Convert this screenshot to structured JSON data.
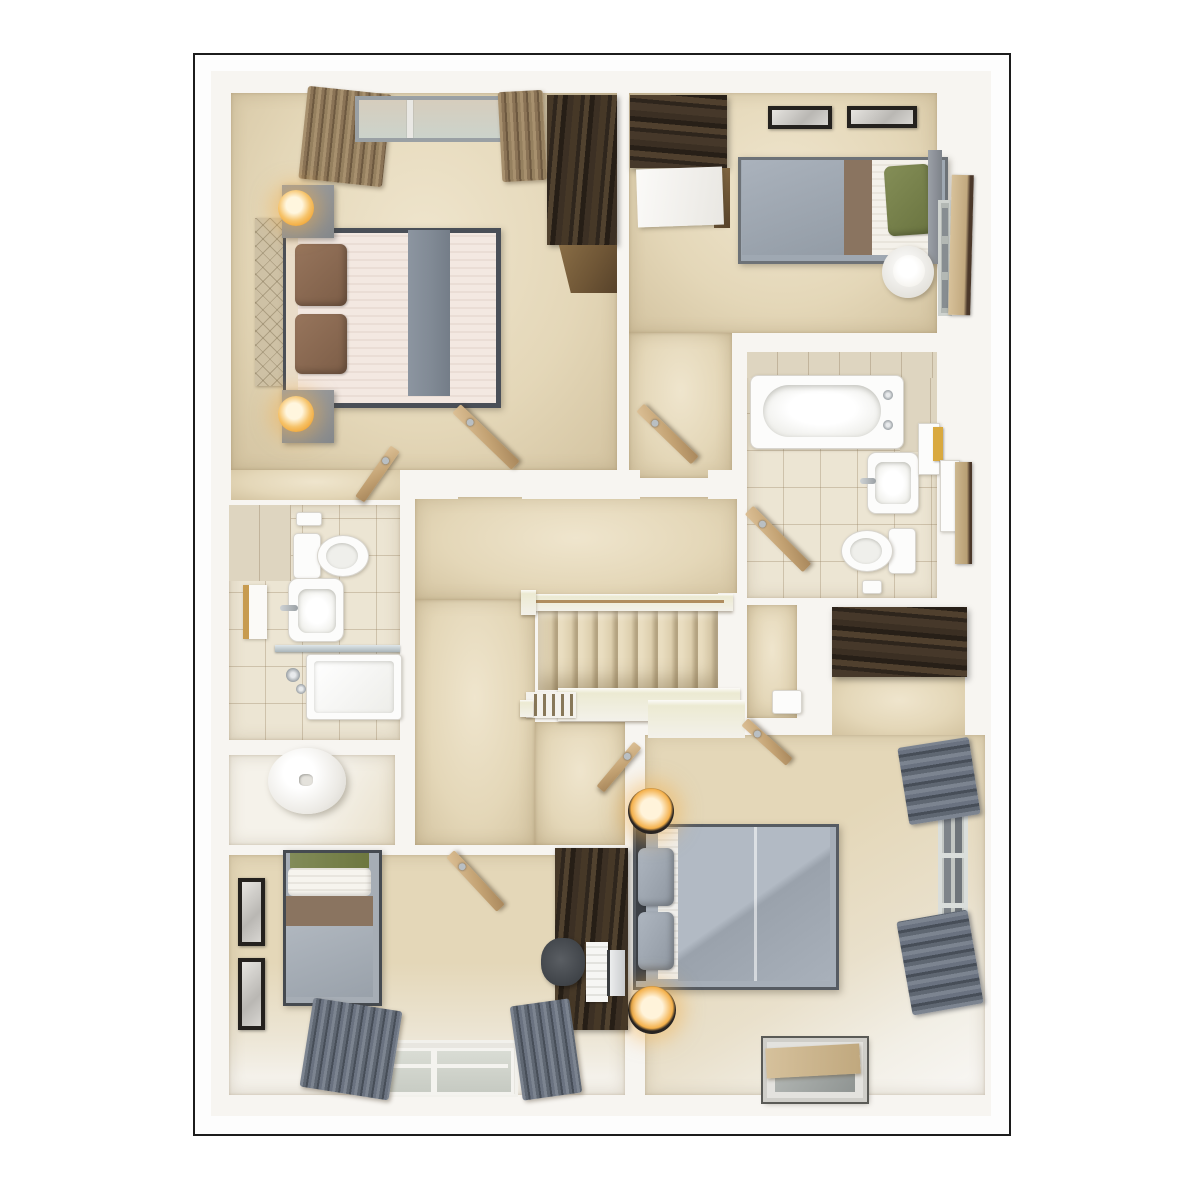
{
  "scene": {
    "description": "Top-down 3D architectural render of an upper-storey house floor plan with four bedrooms, family bathroom, en-suite shower room, airing cupboard and central landing with staircase",
    "view": "top-down dollhouse",
    "visible_text": ""
  },
  "colors": {
    "frame": "#1c1c1c",
    "wall": "#f7f5f1",
    "carpet": "#e4d7b8",
    "carpet_light": "#efe5cd",
    "carpet_dark": "#d3c3a0",
    "tile": "#ece5d3",
    "frame_gray": "#9aa0a4",
    "door_tan": "#c9ab7e",
    "wood_dark": "#342a20",
    "duvet_gray": "#a6aeb8",
    "pillow_green": "#76804f",
    "pillow_brown": "#8c6b53",
    "band_brown": "#8a7460",
    "sheet_cream": "#f3e8e1",
    "throw_gray": "#828b96",
    "curtain_brown": "#95805f",
    "curtain_gray": "#636b76",
    "lamp_glow": "#f2a93b",
    "headboard_tan": "#cec1a5",
    "fixture_white": "#fcfcfb"
  },
  "rooms": [
    {
      "id": "master-bedroom",
      "position": "top-left",
      "furniture": [
        "double-bed",
        "headboard",
        "brown-pillows",
        "gray-throw",
        "two-nightstands",
        "two-lamps",
        "wardrobe",
        "window",
        "brown-curtains",
        "door"
      ]
    },
    {
      "id": "bedroom-2",
      "position": "top-right",
      "furniture": [
        "single-bed",
        "green-pillow",
        "wardrobe-open-door",
        "two-wall-frames",
        "side-table-lamp",
        "window",
        "door"
      ]
    },
    {
      "id": "family-bathroom",
      "position": "right-middle",
      "furniture": [
        "bathtub",
        "basin",
        "toilet",
        "shelving-towels",
        "tiled-floor",
        "door"
      ]
    },
    {
      "id": "en-suite",
      "position": "left-middle",
      "furniture": [
        "toilet",
        "basin",
        "towel-rail",
        "shower-enclosure",
        "tiled-floor"
      ]
    },
    {
      "id": "airing-cupboard",
      "position": "left-middle-lower",
      "furniture": [
        "water-cylinder"
      ]
    },
    {
      "id": "landing",
      "position": "center",
      "furniture": [
        "staircase",
        "handrail",
        "balustrade",
        "console-table",
        "doors"
      ]
    },
    {
      "id": "bedroom-3",
      "position": "bottom-right",
      "furniture": [
        "double-bed",
        "gray-pillows",
        "two-black-lamps",
        "windows",
        "gray-curtains",
        "floor-mirror",
        "door"
      ]
    },
    {
      "id": "bedroom-4",
      "position": "bottom-left",
      "furniture": [
        "single-bed",
        "two-wall-frames",
        "desk",
        "office-chair",
        "monitor",
        "window",
        "gray-curtains",
        "door"
      ]
    }
  ]
}
